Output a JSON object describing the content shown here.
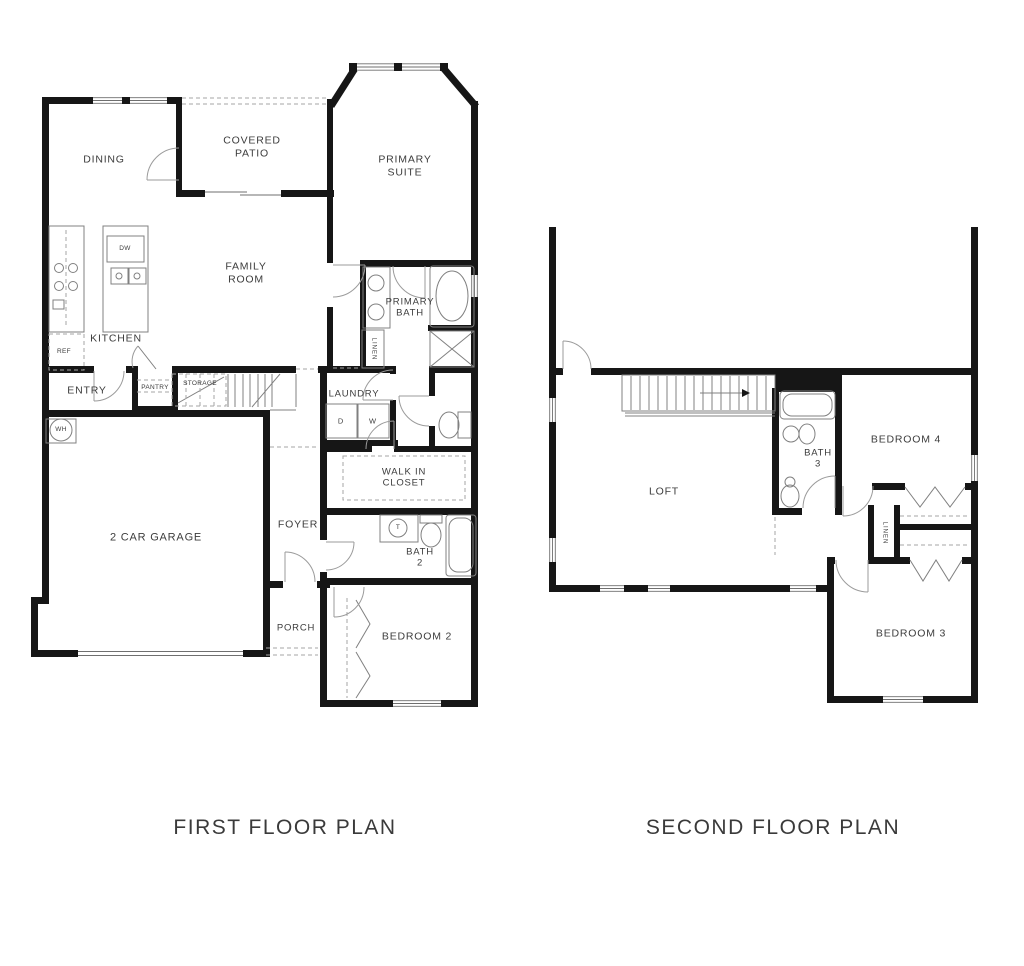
{
  "first_floor": {
    "title": "FIRST FLOOR PLAN",
    "rooms": {
      "dining": "DINING",
      "covered_patio": "COVERED PATIO",
      "primary_suite": "PRIMARY SUITE",
      "family_room": "FAMILY ROOM",
      "kitchen": "KITCHEN",
      "entry": "ENTRY",
      "pantry": "PANTRY",
      "storage": "STORAGE",
      "laundry": "LAUNDRY",
      "primary_bath": "PRIMARY BATH",
      "linen": "LINEN",
      "walk_in_closet": "WALK IN CLOSET",
      "garage": "2 CAR GARAGE",
      "foyer": "FOYER",
      "bath_2": "BATH 2",
      "porch": "PORCH",
      "bedroom_2": "BEDROOM 2"
    },
    "appliances": {
      "refrigerator": "REF",
      "dishwasher": "DW",
      "water_heater": "WH",
      "dryer": "D",
      "washer": "W",
      "toilet_tag": "T"
    }
  },
  "second_floor": {
    "title": "SECOND FLOOR PLAN",
    "rooms": {
      "loft": "LOFT",
      "bath_3": "BATH 3",
      "bedroom_4": "BEDROOM 4",
      "bedroom_3": "BEDROOM 3",
      "linen": "LINEN"
    }
  },
  "colors": {
    "wall": "#161616",
    "line": "#7d7d7d",
    "label": "#3c3c3c",
    "background": "#ffffff"
  }
}
